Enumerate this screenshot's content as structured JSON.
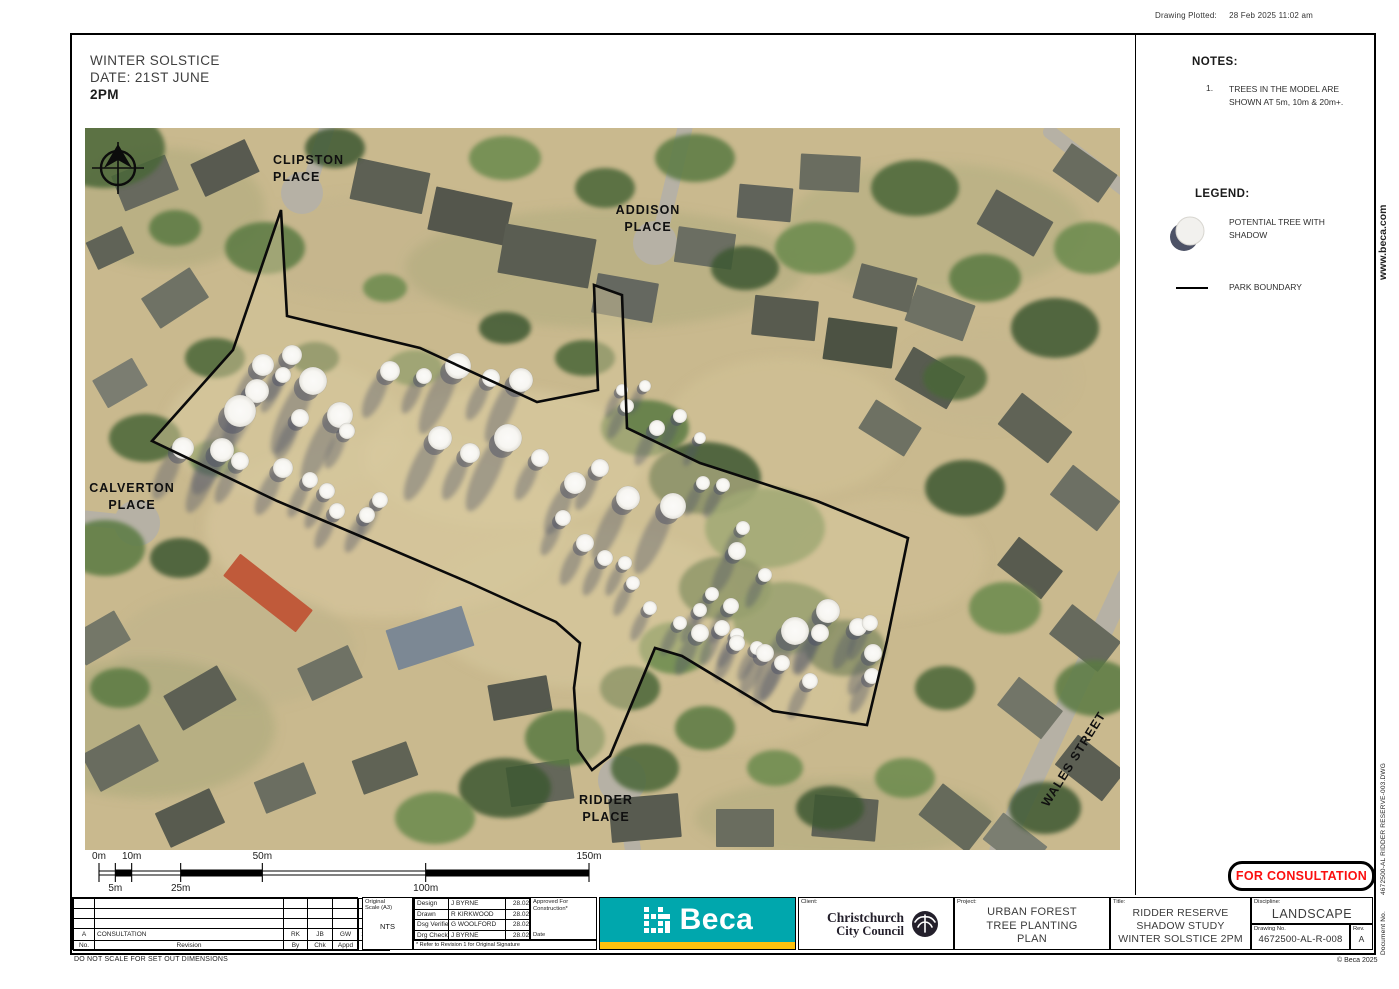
{
  "stamp": {
    "plotted_label": "Drawing Plotted:",
    "plotted_value": "28 Feb 2025   11:02 am"
  },
  "scenario": {
    "line1": "WINTER SOLSTICE",
    "line2": "DATE: 21ST JUNE",
    "line3": "2PM"
  },
  "notes": {
    "heading": "NOTES:",
    "items": [
      {
        "num": "1.",
        "text": "TREES IN THE MODEL ARE SHOWN AT 5m, 10m & 20m+."
      }
    ]
  },
  "legend": {
    "heading": "LEGEND:",
    "tree_label": "POTENTIAL TREE WITH SHADOW",
    "boundary_label": "PARK BOUNDARY"
  },
  "consultation_stamp": "FOR CONSULTATION",
  "side": {
    "website": "www.beca.com",
    "document_no_vertical": "Document No.        4672500-AL RIDDER RESERVE-003.DWG"
  },
  "footer": {
    "do_not_scale": "DO NOT SCALE FOR SET OUT DIMENSIONS",
    "copyright": "© Beca 2025"
  },
  "title_block": {
    "revision": {
      "headers": {
        "no": "No.",
        "revision": "Revision",
        "by": "By",
        "chk": "Chk",
        "appd": "Appd",
        "date": "Date"
      },
      "rows": [
        {
          "no": "A",
          "revision": "CONSULTATION",
          "by": "RK",
          "chk": "JB",
          "appd": "GW",
          "date": "28.02.25"
        }
      ],
      "blank_rows": 3
    },
    "scale_box": {
      "label_line1": "Original",
      "label_line2": "Scale (A3)",
      "value": "NTS"
    },
    "approvals": [
      {
        "role": "Design",
        "name": "J BYRNE",
        "date": "28.02.25"
      },
      {
        "role": "Drawn",
        "name": "R KIRKWOOD",
        "date": "28.02.25"
      },
      {
        "role": "Dsg Verifier",
        "name": "G WOOLFORD",
        "date": "28.02.25"
      },
      {
        "role": "Drg Check",
        "name": "J BYRNE",
        "date": "28.02.25"
      }
    ],
    "approved_for": "Approved For Construction*",
    "approved_date_label": "Date",
    "footnote": "* Refer to Revision 1 for Original Signature",
    "beca_logo_text": "Beca",
    "client_label": "Client:",
    "client_line1": "Christchurch",
    "client_line2": "City Council",
    "project_label": "Project:",
    "project_lines": [
      "URBAN FOREST",
      "TREE PLANTING",
      "PLAN"
    ],
    "title_label": "Title:",
    "title_lines": [
      "RIDDER RESERVE",
      "SHADOW STUDY",
      "WINTER SOLSTICE 2PM"
    ],
    "discipline_label": "Discipline:",
    "discipline": "LANDSCAPE",
    "drawing_no_label": "Drawing No.",
    "drawing_no": "4672500-AL-R-008",
    "rev_label": "Rev.",
    "rev": "A"
  },
  "scale_bar": {
    "points": [
      {
        "m": 0,
        "label": "0m",
        "side": "above"
      },
      {
        "m": 5,
        "label": "5m",
        "side": "below"
      },
      {
        "m": 10,
        "label": "10m",
        "side": "above"
      },
      {
        "m": 25,
        "label": "25m",
        "side": "below"
      },
      {
        "m": 50,
        "label": "50m",
        "side": "above"
      },
      {
        "m": 100,
        "label": "100m",
        "side": "below"
      },
      {
        "m": 150,
        "label": "150m",
        "side": "above"
      }
    ],
    "filled_segments": [
      [
        5,
        10
      ],
      [
        25,
        50
      ],
      [
        100,
        150
      ]
    ],
    "px_per_m": 3.2667
  },
  "map": {
    "street_labels": [
      {
        "lines": [
          "CLIPSTON",
          "PLACE"
        ],
        "x": 188,
        "y": 30,
        "anchor": "start",
        "rotate": 0
      },
      {
        "lines": [
          "ADDISON",
          "PLACE"
        ],
        "x": 563,
        "y": 80,
        "anchor": "middle",
        "rotate": 0
      },
      {
        "lines": [
          "CALVERTON",
          "PLACE"
        ],
        "x": 47,
        "y": 358,
        "anchor": "middle",
        "rotate": 0
      },
      {
        "lines": [
          "RIDDER",
          "PLACE"
        ],
        "x": 521,
        "y": 670,
        "anchor": "middle",
        "rotate": 0
      },
      {
        "lines": [
          "WALES STREET"
        ],
        "x": 987,
        "y": 630,
        "anchor": "middle",
        "rotate": -58
      }
    ],
    "boundary": [
      [
        196,
        82
      ],
      [
        202,
        188
      ],
      [
        335,
        220
      ],
      [
        452,
        274
      ],
      [
        513,
        262
      ],
      [
        509,
        157
      ],
      [
        537,
        167
      ],
      [
        542,
        300
      ],
      [
        615,
        335
      ],
      [
        732,
        373
      ],
      [
        823,
        410
      ],
      [
        802,
        513
      ],
      [
        782,
        597
      ],
      [
        688,
        583
      ],
      [
        597,
        528
      ],
      [
        570,
        520
      ],
      [
        525,
        628
      ],
      [
        507,
        642
      ],
      [
        493,
        622
      ],
      [
        489,
        560
      ],
      [
        495,
        515
      ],
      [
        471,
        494
      ],
      [
        385,
        455
      ],
      [
        275,
        408
      ],
      [
        192,
        373
      ],
      [
        67,
        313
      ],
      [
        148,
        222
      ]
    ],
    "trees": [
      [
        178,
        237,
        11
      ],
      [
        207,
        227,
        10
      ],
      [
        198,
        247,
        8
      ],
      [
        228,
        253,
        14
      ],
      [
        172,
        263,
        12
      ],
      [
        155,
        283,
        16
      ],
      [
        255,
        287,
        13
      ],
      [
        215,
        290,
        9
      ],
      [
        98,
        320,
        11
      ],
      [
        137,
        322,
        12
      ],
      [
        155,
        333,
        9
      ],
      [
        198,
        340,
        10
      ],
      [
        225,
        352,
        8
      ],
      [
        242,
        363,
        8
      ],
      [
        252,
        383,
        8
      ],
      [
        282,
        387,
        8
      ],
      [
        295,
        372,
        8
      ],
      [
        262,
        303,
        8
      ],
      [
        305,
        243,
        10
      ],
      [
        339,
        248,
        8
      ],
      [
        373,
        238,
        13
      ],
      [
        406,
        250,
        9
      ],
      [
        436,
        252,
        12
      ],
      [
        355,
        310,
        12
      ],
      [
        385,
        325,
        10
      ],
      [
        423,
        310,
        14
      ],
      [
        455,
        330,
        9
      ],
      [
        490,
        355,
        11
      ],
      [
        515,
        340,
        9
      ],
      [
        478,
        390,
        8
      ],
      [
        500,
        415,
        9
      ],
      [
        520,
        430,
        8
      ],
      [
        537,
        262,
        6
      ],
      [
        542,
        278,
        7
      ],
      [
        560,
        258,
        6
      ],
      [
        572,
        300,
        8
      ],
      [
        595,
        288,
        7
      ],
      [
        615,
        310,
        6
      ],
      [
        543,
        370,
        12
      ],
      [
        588,
        378,
        13
      ],
      [
        618,
        355,
        7
      ],
      [
        638,
        357,
        7
      ],
      [
        658,
        400,
        7
      ],
      [
        652,
        423,
        9
      ],
      [
        680,
        447,
        7
      ],
      [
        540,
        435,
        7
      ],
      [
        548,
        455,
        7
      ],
      [
        565,
        480,
        7
      ],
      [
        595,
        495,
        7
      ],
      [
        615,
        482,
        7
      ],
      [
        627,
        466,
        7
      ],
      [
        646,
        478,
        8
      ],
      [
        652,
        507,
        7
      ],
      [
        672,
        520,
        7
      ],
      [
        743,
        483,
        12
      ],
      [
        773,
        499,
        9
      ],
      [
        710,
        503,
        14
      ],
      [
        615,
        505,
        9
      ],
      [
        637,
        500,
        8
      ],
      [
        652,
        515,
        8
      ],
      [
        680,
        525,
        9
      ],
      [
        697,
        535,
        8
      ],
      [
        735,
        505,
        9
      ],
      [
        785,
        495,
        8
      ],
      [
        788,
        525,
        9
      ],
      [
        787,
        548,
        8
      ],
      [
        725,
        553,
        8
      ]
    ]
  },
  "colors": {
    "beca_teal": "#00a7ad",
    "beca_yellow": "#ffc20e",
    "stamp_red": "#fb0f0f",
    "shadow": "#4d5266",
    "tree_fill": "#f7f6f2",
    "boundary": "#0a0a0a",
    "ground": "#c9b98e",
    "road": "#b6b1a5"
  }
}
